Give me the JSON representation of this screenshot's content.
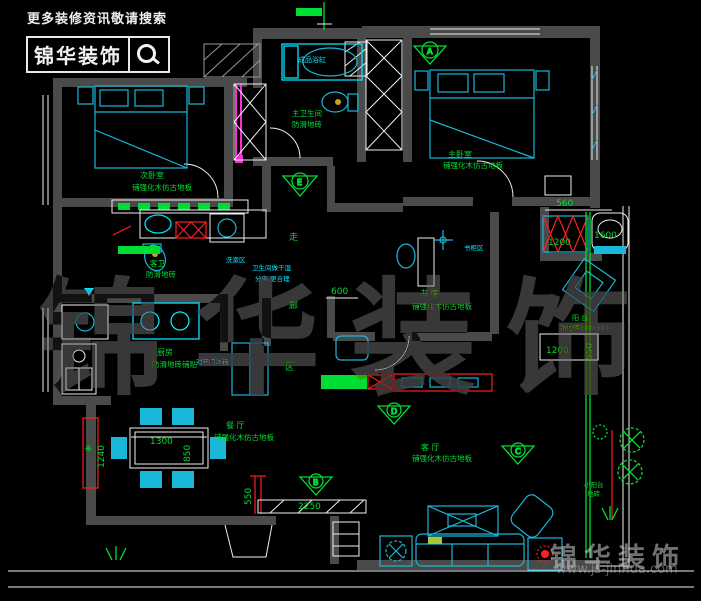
{
  "header": {
    "tagline": "更多装修资讯敬请搜索",
    "brand": "锦华装饰",
    "search_icon": "magnifier"
  },
  "watermark": {
    "center": "锦华装饰",
    "brand": "锦华装饰",
    "url": "www.js-jinhua.com"
  },
  "rooms": {
    "bedroom2": {
      "name": "次卧室",
      "floor": "铺强化木仿古地板"
    },
    "master": {
      "name": "主卧室",
      "floor": "铺强化木仿古地板"
    },
    "master_bath": {
      "name": "主卫生间",
      "floor": "防滑地砖"
    },
    "guest_bath": {
      "name": "客卫",
      "floor": "防滑地砖"
    },
    "study": {
      "name": "书 房",
      "floor": "铺强化木仿古地板"
    },
    "kitchen": {
      "name": "厨房",
      "floor": "防滑地砖铺贴"
    },
    "dining": {
      "name": "餐 厅",
      "floor": "铺强化木仿古地板"
    },
    "living": {
      "name": "客 厅",
      "floor": "铺强化木仿古地板"
    },
    "balcony": {
      "name": "阳 台",
      "floor": "铺地砖300X600"
    },
    "side_balcony": {
      "name": "小阳台",
      "floor": "地砖"
    }
  },
  "annotations": {
    "bathtub": "成品浴缸",
    "wash_area": "洗漱区",
    "note_line1": "卫生间做干湿",
    "note_line2": "分离 更合理",
    "fridge": "对开门冰箱",
    "bookcase": "书柜区",
    "corridor_char1": "走",
    "corridor_char2": "廊",
    "corridor_char3": "区"
  },
  "dimensions": {
    "d560": "560",
    "d1200a": "1200",
    "d1600": "1600",
    "d600": "600",
    "d1300": "1300",
    "d850": "850",
    "d1240": "1240",
    "d550a": "550",
    "d2250": "2250",
    "d1200b": "1200",
    "d550b": "550"
  },
  "markers": {
    "a": "A",
    "e": "E",
    "d": "D",
    "b": "B",
    "c": "C"
  },
  "colors": {
    "wall": "#4a4a4a",
    "cyan": "#19b8d8",
    "bcyan": "#00e5ff",
    "green": "#00dd33",
    "red": "#ff1f1f",
    "magenta": "#ff2bd6",
    "white": "#efefef",
    "bg": "#000000"
  }
}
